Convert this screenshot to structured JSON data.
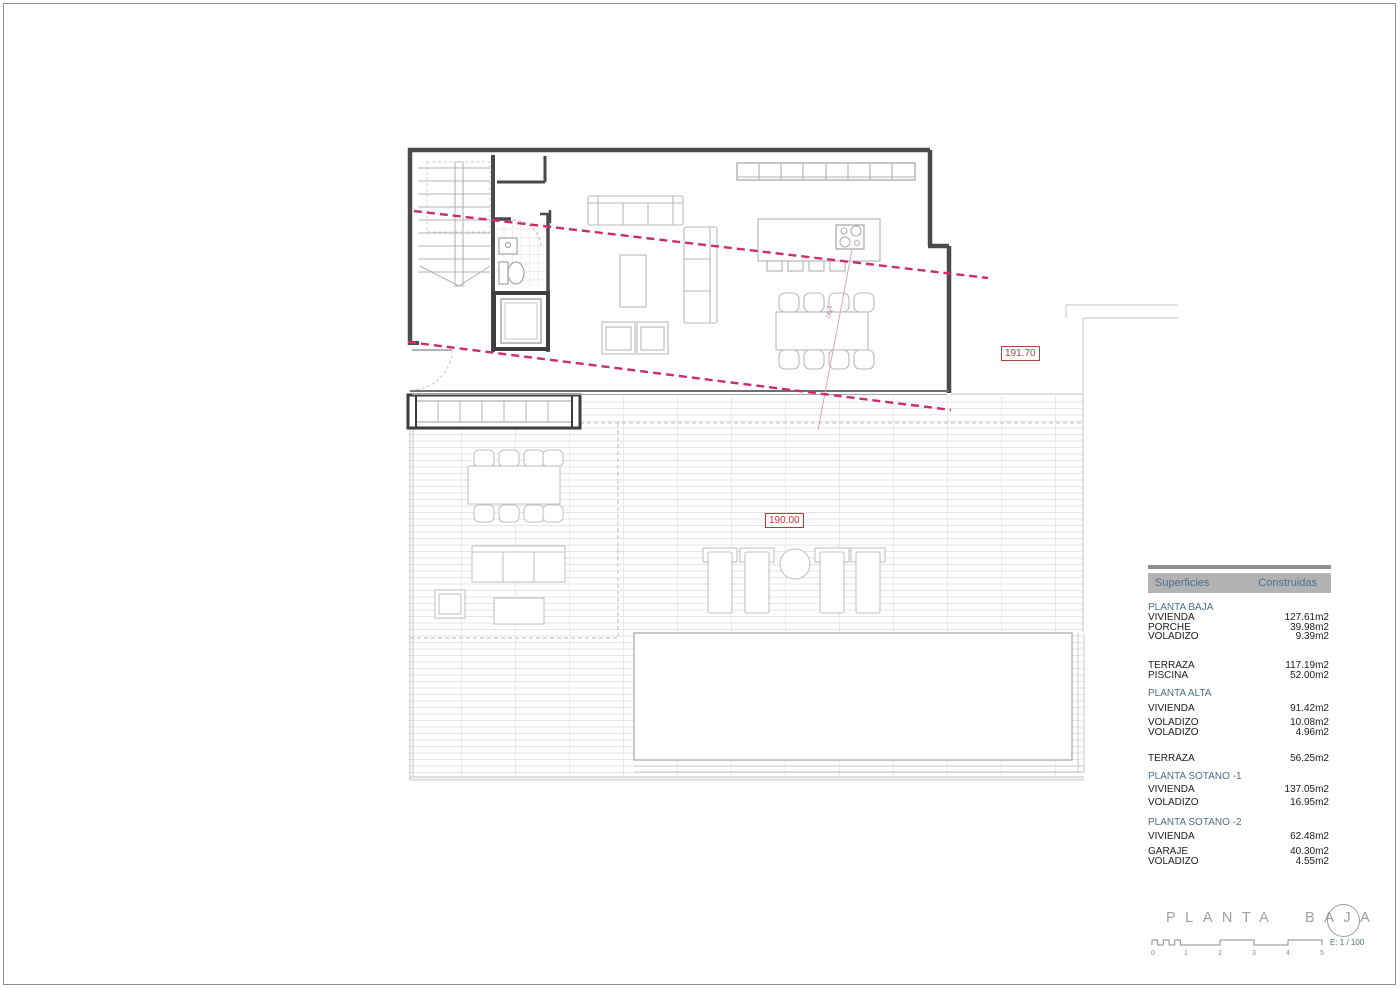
{
  "plan": {
    "markers": {
      "upper_terrace_level": "191.70",
      "terrace_level": "190.00",
      "slope_label": "1.90"
    },
    "colors": {
      "section_line_magenta": "#cb2c6f",
      "level_marker_red": "#bf3a31",
      "level_marker_dark_red": "#a8443e",
      "table_blue": "#4c6e8c",
      "wall_gray": "#4a4a4a"
    }
  },
  "areas_table": {
    "header": {
      "col1": "Superficies",
      "col2": "Construidas"
    },
    "rows": [
      {
        "kind": "section",
        "label": "PLANTA BAJA",
        "value": ""
      },
      {
        "kind": "item",
        "label": "VIVIENDA",
        "value": "127.61m2"
      },
      {
        "kind": "item",
        "label": "PORCHE",
        "value": "39.98m2"
      },
      {
        "kind": "item",
        "label": "VOLADIZO",
        "value": "9.39m2"
      },
      {
        "kind": "item",
        "label": "TERRAZA",
        "value": "117.19m2"
      },
      {
        "kind": "item",
        "label": "PISCINA",
        "value": "52.00m2"
      },
      {
        "kind": "section",
        "label": "PLANTA ALTA",
        "value": ""
      },
      {
        "kind": "item",
        "label": "VIVIENDA",
        "value": "91.42m2"
      },
      {
        "kind": "item",
        "label": "VOLADIZO",
        "value": "10.08m2"
      },
      {
        "kind": "item",
        "label": "VOLADIZO",
        "value": "4.96m2"
      },
      {
        "kind": "item",
        "label": "TERRAZA",
        "value": "56.25m2"
      },
      {
        "kind": "section",
        "label": "PLANTA SOTANO -1",
        "value": ""
      },
      {
        "kind": "item",
        "label": "VIVIENDA",
        "value": "137.05m2"
      },
      {
        "kind": "item",
        "label": "VOLADIZO",
        "value": "16.95m2"
      },
      {
        "kind": "section",
        "label": "PLANTA SOTANO -2",
        "value": ""
      },
      {
        "kind": "item",
        "label": "VIVIENDA",
        "value": "62.48m2"
      },
      {
        "kind": "item",
        "label": "GARAJE",
        "value": "40.30m2"
      },
      {
        "kind": "item",
        "label": "VOLADIZO",
        "value": "4.55m2"
      }
    ]
  },
  "title_block": {
    "title": "PLANTA BAJA",
    "scale_text": "E: 1 / 100",
    "scale_ticks": [
      "0",
      "1",
      "2",
      "3",
      "4",
      "5"
    ]
  }
}
